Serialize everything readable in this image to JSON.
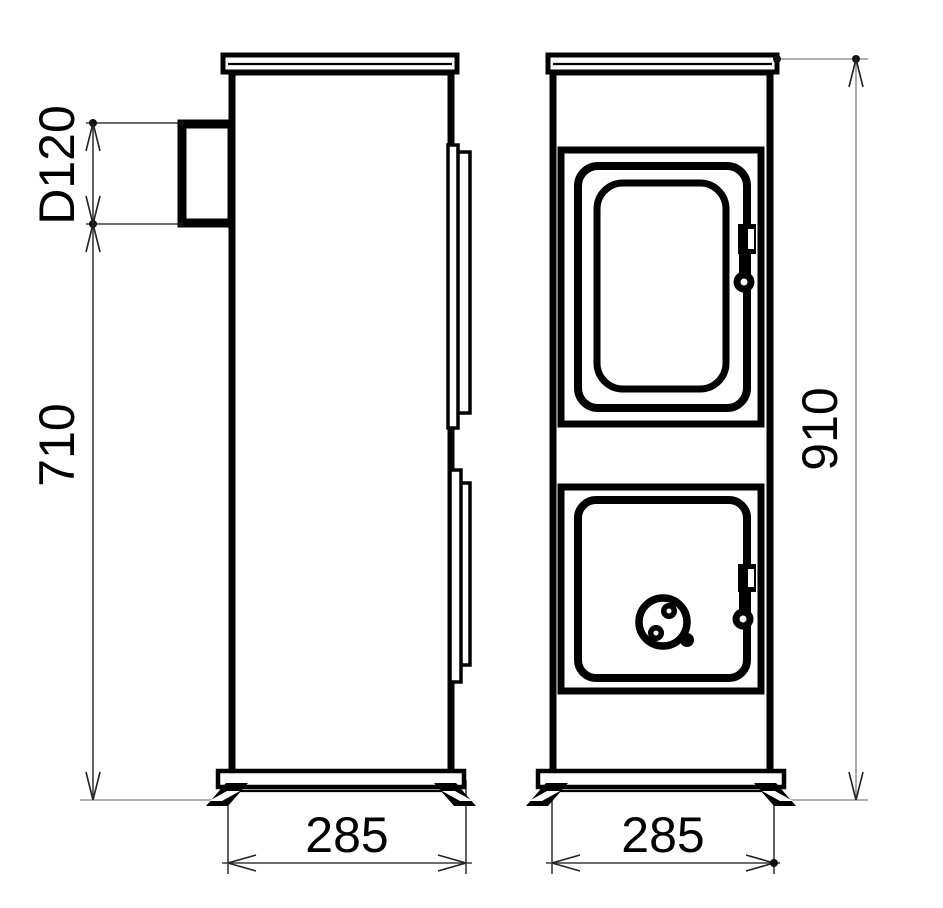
{
  "drawing": {
    "type": "stove-technical-drawing",
    "views": [
      "side-view",
      "front-view"
    ],
    "dimensions": {
      "flue_diameter": "D120",
      "flue_height_span": "710",
      "overall_height": "910",
      "side_depth": "285",
      "front_width": "285"
    }
  },
  "colors": {
    "background": "#ffffff",
    "line": "#000000",
    "dimension_line": "#3a3a3a",
    "extension_line": "#969696"
  }
}
